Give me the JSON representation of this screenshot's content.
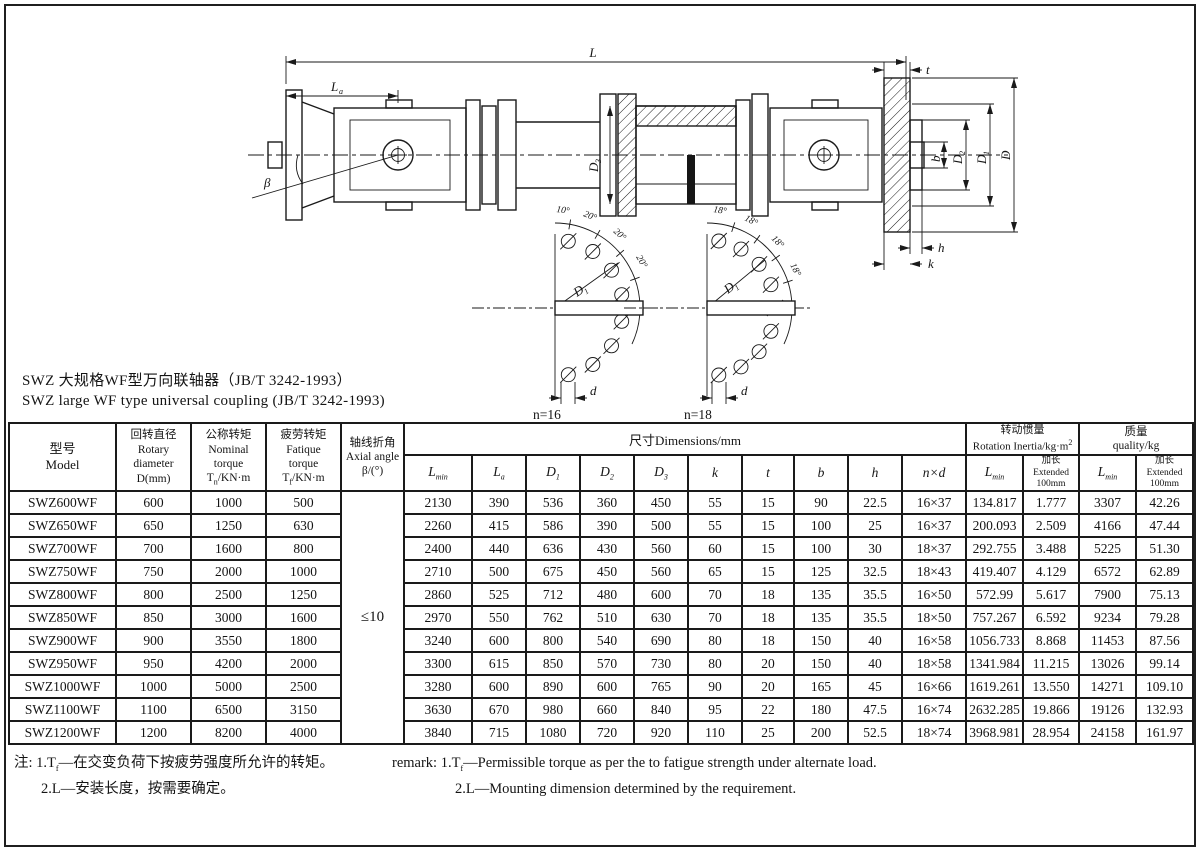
{
  "colors": {
    "ink": "#1a1a1a",
    "paper": "#ffffff"
  },
  "page": {
    "title_zh": "SWZ 大规格WF型万向联轴器（JB/T 3242-1993）",
    "title_en": "SWZ large WF type universal coupling (JB/T 3242-1993)"
  },
  "drawing": {
    "L": "L",
    "La": {
      "base": "L",
      "sub": "a"
    },
    "beta": "β",
    "t": "t",
    "b": "b",
    "h": "h",
    "k": "k",
    "D": "D",
    "D1": {
      "base": "D",
      "sub": "1"
    },
    "D2": {
      "base": "D",
      "sub": "2"
    },
    "tube": {
      "base": "D",
      "sub": "3"
    },
    "left_view": {
      "angles": [
        "10°",
        "20°",
        "20°",
        "20°"
      ],
      "radius": {
        "base": "D",
        "sub": "1"
      },
      "hole_dia": "d",
      "count": "n=16"
    },
    "right_view": {
      "angles": [
        "18°",
        "18°",
        "18°",
        "18°"
      ],
      "radius": {
        "base": "D",
        "sub": "1"
      },
      "hole_dia": "d",
      "count": "n=18"
    }
  },
  "table": {
    "header": {
      "model": "型号\nModel",
      "diameter": "回转直径\nRotary\ndiameter\nD(mm)",
      "nominal_top": "公称转矩\nNominal\ntorque",
      "nominal_sym": "T",
      "nominal_sub": "n",
      "nominal_unit": "/KN·m",
      "fatigue_top": "疲劳转矩\nFatique\ntorque",
      "fatigue_sym": "T",
      "fatigue_sub": "f",
      "fatigue_unit": "/KN·m",
      "angle": "轴线折角\nAxial angle\nβ/(°)",
      "dims_group": "尺寸Dimensions/mm",
      "inertia_group": "转动惯量\nRotation Inertia/kg·m",
      "inertia_sup": "2",
      "mass_group": "质量\nquality/kg",
      "lmin_col": {
        "b": "L",
        "s": "min"
      },
      "ext_col": "加长\nExtended\n100mm",
      "dim_cols": [
        {
          "b": "L",
          "s": "min"
        },
        {
          "b": "L",
          "s": "a"
        },
        {
          "b": "D",
          "s": "1"
        },
        {
          "b": "D",
          "s": "2"
        },
        {
          "b": "D",
          "s": "3"
        },
        {
          "b": "k",
          "s": ""
        },
        {
          "b": "t",
          "s": ""
        },
        {
          "b": "b",
          "s": ""
        },
        {
          "b": "h",
          "s": ""
        },
        {
          "b": "n×d",
          "s": ""
        }
      ]
    },
    "axial_angle_value": "≤10",
    "rows": [
      {
        "model": "SWZ600WF",
        "d": "600",
        "tn": "1000",
        "tf": "500",
        "dims": [
          "2130",
          "390",
          "536",
          "360",
          "450",
          "55",
          "15",
          "90",
          "22.5",
          "16×37"
        ],
        "inertia": [
          "134.817",
          "1.777"
        ],
        "mass": [
          "3307",
          "42.26"
        ]
      },
      {
        "model": "SWZ650WF",
        "d": "650",
        "tn": "1250",
        "tf": "630",
        "dims": [
          "2260",
          "415",
          "586",
          "390",
          "500",
          "55",
          "15",
          "100",
          "25",
          "16×37"
        ],
        "inertia": [
          "200.093",
          "2.509"
        ],
        "mass": [
          "4166",
          "47.44"
        ]
      },
      {
        "model": "SWZ700WF",
        "d": "700",
        "tn": "1600",
        "tf": "800",
        "dims": [
          "2400",
          "440",
          "636",
          "430",
          "560",
          "60",
          "15",
          "100",
          "30",
          "18×37"
        ],
        "inertia": [
          "292.755",
          "3.488"
        ],
        "mass": [
          "5225",
          "51.30"
        ]
      },
      {
        "model": "SWZ750WF",
        "d": "750",
        "tn": "2000",
        "tf": "1000",
        "dims": [
          "2710",
          "500",
          "675",
          "450",
          "560",
          "65",
          "15",
          "125",
          "32.5",
          "18×43"
        ],
        "inertia": [
          "419.407",
          "4.129"
        ],
        "mass": [
          "6572",
          "62.89"
        ]
      },
      {
        "model": "SWZ800WF",
        "d": "800",
        "tn": "2500",
        "tf": "1250",
        "dims": [
          "2860",
          "525",
          "712",
          "480",
          "600",
          "70",
          "18",
          "135",
          "35.5",
          "16×50"
        ],
        "inertia": [
          "572.99",
          "5.617"
        ],
        "mass": [
          "7900",
          "75.13"
        ]
      },
      {
        "model": "SWZ850WF",
        "d": "850",
        "tn": "3000",
        "tf": "1600",
        "dims": [
          "2970",
          "550",
          "762",
          "510",
          "630",
          "70",
          "18",
          "135",
          "35.5",
          "18×50"
        ],
        "inertia": [
          "757.267",
          "6.592"
        ],
        "mass": [
          "9234",
          "79.28"
        ]
      },
      {
        "model": "SWZ900WF",
        "d": "900",
        "tn": "3550",
        "tf": "1800",
        "dims": [
          "3240",
          "600",
          "800",
          "540",
          "690",
          "80",
          "18",
          "150",
          "40",
          "16×58"
        ],
        "inertia": [
          "1056.733",
          "8.868"
        ],
        "mass": [
          "11453",
          "87.56"
        ]
      },
      {
        "model": "SWZ950WF",
        "d": "950",
        "tn": "4200",
        "tf": "2000",
        "dims": [
          "3300",
          "615",
          "850",
          "570",
          "730",
          "80",
          "20",
          "150",
          "40",
          "18×58"
        ],
        "inertia": [
          "1341.984",
          "11.215"
        ],
        "mass": [
          "13026",
          "99.14"
        ]
      },
      {
        "model": "SWZ1000WF",
        "d": "1000",
        "tn": "5000",
        "tf": "2500",
        "dims": [
          "3280",
          "600",
          "890",
          "600",
          "765",
          "90",
          "20",
          "165",
          "45",
          "16×66"
        ],
        "inertia": [
          "1619.261",
          "13.550"
        ],
        "mass": [
          "14271",
          "109.10"
        ]
      },
      {
        "model": "SWZ1100WF",
        "d": "1100",
        "tn": "6500",
        "tf": "3150",
        "dims": [
          "3630",
          "670",
          "980",
          "660",
          "840",
          "95",
          "22",
          "180",
          "47.5",
          "16×74"
        ],
        "inertia": [
          "2632.285",
          "19.866"
        ],
        "mass": [
          "19126",
          "132.93"
        ]
      },
      {
        "model": "SWZ1200WF",
        "d": "1200",
        "tn": "8200",
        "tf": "4000",
        "dims": [
          "3840",
          "715",
          "1080",
          "720",
          "920",
          "110",
          "25",
          "200",
          "52.5",
          "18×74"
        ],
        "inertia": [
          "3968.981",
          "28.954"
        ],
        "mass": [
          "24158",
          "161.97"
        ]
      }
    ]
  },
  "notes": {
    "zh1_pre": "注: 1.T",
    "zh1_sub": "f",
    "zh1_rest": "—在交变负荷下按疲劳强度所允许的转矩。",
    "zh2": "2.L—安装长度，按需要确定。",
    "en1_pre": "remark: 1.T",
    "en1_sub": "f",
    "en1_rest": "—Permissible torque as per the to fatigue strength under alternate load.",
    "en2": "2.L—Mounting dimension determined by the requirement."
  }
}
